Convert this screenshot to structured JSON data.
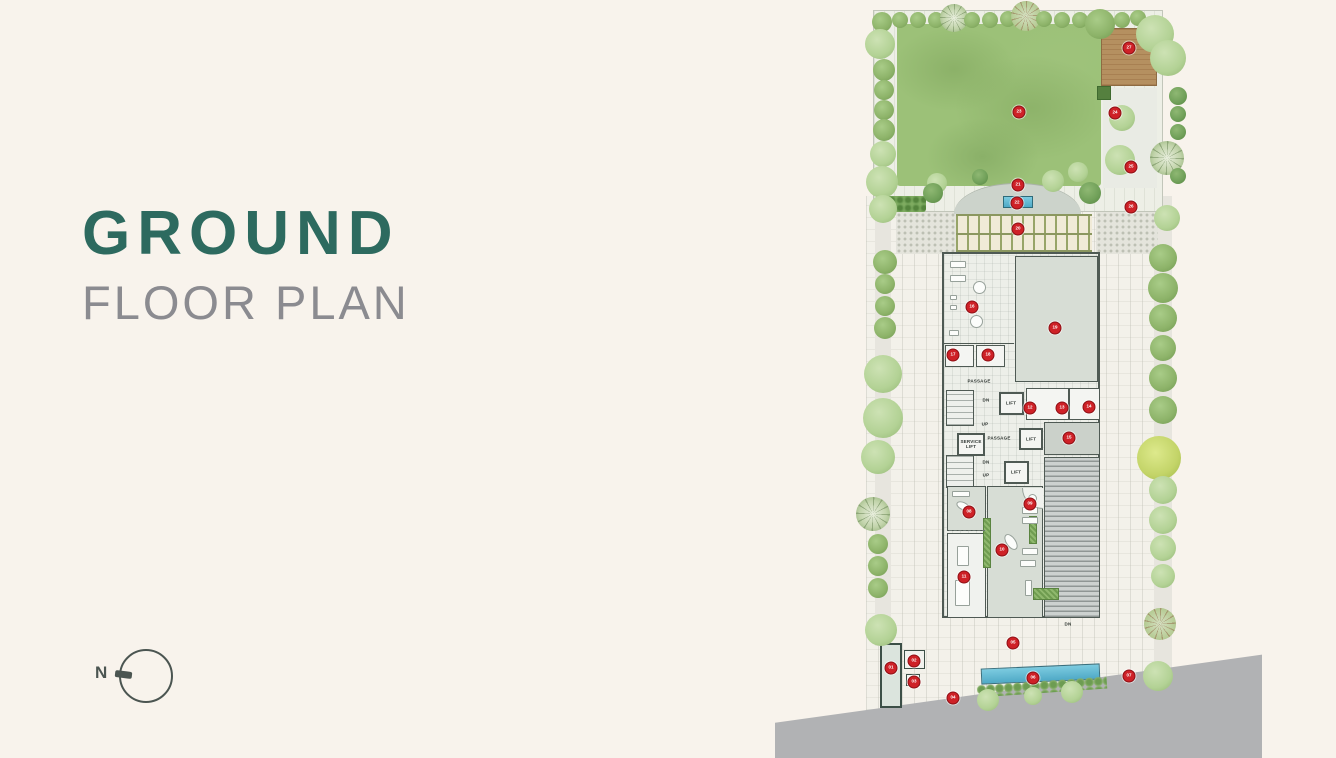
{
  "title": {
    "line1": "GROUND",
    "line2": "FLOOR PLAN"
  },
  "compass": {
    "label": "N"
  },
  "colors": {
    "background": "#f8f3ec",
    "title_accent": "#2d6a5f",
    "title_gray": "#8b8b90",
    "lawn": "#9cc178",
    "road": "#b1b2b4",
    "water": "#5cb8d3",
    "marker_red": "#ce2127",
    "deck_wood": "#b28a5b",
    "wall": "#4f5a54"
  },
  "plan": {
    "labels": [
      {
        "text": "PASSAGE",
        "x": 209,
        "y": 381
      },
      {
        "text": "DN",
        "x": 216,
        "y": 400
      },
      {
        "text": "UP",
        "x": 215,
        "y": 424
      },
      {
        "text": "LIFT",
        "x": 241,
        "y": 403
      },
      {
        "text": "SERVICE LIFT",
        "x": 201,
        "y": 444,
        "w": 24
      },
      {
        "text": "PASSAGE",
        "x": 229,
        "y": 438
      },
      {
        "text": "LIFT",
        "x": 261,
        "y": 439
      },
      {
        "text": "DN",
        "x": 216,
        "y": 462
      },
      {
        "text": "UP",
        "x": 216,
        "y": 475
      },
      {
        "text": "LIFT",
        "x": 246,
        "y": 472
      },
      {
        "text": "DN",
        "x": 298,
        "y": 624
      }
    ],
    "markers": [
      {
        "n": "01",
        "x": 121,
        "y": 668
      },
      {
        "n": "02",
        "x": 144,
        "y": 661
      },
      {
        "n": "03",
        "x": 144,
        "y": 682
      },
      {
        "n": "04",
        "x": 183,
        "y": 698
      },
      {
        "n": "05",
        "x": 243,
        "y": 643
      },
      {
        "n": "06",
        "x": 263,
        "y": 678
      },
      {
        "n": "07",
        "x": 359,
        "y": 676
      },
      {
        "n": "08",
        "x": 199,
        "y": 512
      },
      {
        "n": "09",
        "x": 260,
        "y": 504
      },
      {
        "n": "10",
        "x": 232,
        "y": 550
      },
      {
        "n": "11",
        "x": 194,
        "y": 577
      },
      {
        "n": "12",
        "x": 260,
        "y": 408
      },
      {
        "n": "13",
        "x": 292,
        "y": 408
      },
      {
        "n": "14",
        "x": 319,
        "y": 407
      },
      {
        "n": "15",
        "x": 299,
        "y": 438
      },
      {
        "n": "16",
        "x": 202,
        "y": 307
      },
      {
        "n": "17",
        "x": 183,
        "y": 355
      },
      {
        "n": "18",
        "x": 218,
        "y": 355
      },
      {
        "n": "19",
        "x": 285,
        "y": 328
      },
      {
        "n": "20",
        "x": 248,
        "y": 229
      },
      {
        "n": "21",
        "x": 248,
        "y": 185
      },
      {
        "n": "22",
        "x": 247,
        "y": 203
      },
      {
        "n": "23",
        "x": 249,
        "y": 112
      },
      {
        "n": "24",
        "x": 345,
        "y": 113
      },
      {
        "n": "25",
        "x": 361,
        "y": 167
      },
      {
        "n": "26",
        "x": 361,
        "y": 207
      },
      {
        "n": "27",
        "x": 359,
        "y": 48
      }
    ],
    "trees": [
      {
        "x": 112,
        "y": 22,
        "d": 20,
        "c": "d"
      },
      {
        "x": 130,
        "y": 20,
        "d": 16,
        "c": "d"
      },
      {
        "x": 148,
        "y": 20,
        "d": 16,
        "c": "d"
      },
      {
        "x": 166,
        "y": 20,
        "d": 16,
        "c": "d"
      },
      {
        "x": 184,
        "y": 18,
        "d": 28,
        "c": "b"
      },
      {
        "x": 202,
        "y": 20,
        "d": 16,
        "c": "d"
      },
      {
        "x": 220,
        "y": 20,
        "d": 16,
        "c": "d"
      },
      {
        "x": 238,
        "y": 19,
        "d": 16,
        "c": "d"
      },
      {
        "x": 256,
        "y": 16,
        "d": 30,
        "c": "w"
      },
      {
        "x": 274,
        "y": 19,
        "d": 16,
        "c": "d"
      },
      {
        "x": 292,
        "y": 20,
        "d": 16,
        "c": "d"
      },
      {
        "x": 310,
        "y": 20,
        "d": 16,
        "c": "d"
      },
      {
        "x": 330,
        "y": 24,
        "d": 30,
        "c": "d"
      },
      {
        "x": 352,
        "y": 20,
        "d": 16,
        "c": "d"
      },
      {
        "x": 368,
        "y": 18,
        "d": 16,
        "c": "d"
      },
      {
        "x": 385,
        "y": 34,
        "d": 38,
        "c": "p"
      },
      {
        "x": 110,
        "y": 44,
        "d": 30,
        "c": "p"
      },
      {
        "x": 114,
        "y": 70,
        "d": 22,
        "c": "d"
      },
      {
        "x": 114,
        "y": 90,
        "d": 20,
        "c": "d"
      },
      {
        "x": 114,
        "y": 110,
        "d": 20,
        "c": "d"
      },
      {
        "x": 114,
        "y": 130,
        "d": 22,
        "c": "d"
      },
      {
        "x": 113,
        "y": 154,
        "d": 26,
        "c": "p"
      },
      {
        "x": 112,
        "y": 182,
        "d": 32,
        "c": "p"
      },
      {
        "x": 113,
        "y": 209,
        "d": 28,
        "c": "p"
      },
      {
        "x": 167,
        "y": 183,
        "d": 20,
        "c": "p"
      },
      {
        "x": 163,
        "y": 193,
        "d": 20,
        "c": "t"
      },
      {
        "x": 210,
        "y": 177,
        "d": 16,
        "c": "t"
      },
      {
        "x": 283,
        "y": 181,
        "d": 22,
        "c": "p"
      },
      {
        "x": 308,
        "y": 172,
        "d": 20,
        "c": "p"
      },
      {
        "x": 320,
        "y": 193,
        "d": 22,
        "c": "t"
      },
      {
        "x": 352,
        "y": 118,
        "d": 26,
        "c": "p"
      },
      {
        "x": 350,
        "y": 160,
        "d": 30,
        "c": "p"
      },
      {
        "x": 398,
        "y": 58,
        "d": 36,
        "c": "p"
      },
      {
        "x": 408,
        "y": 96,
        "d": 18,
        "c": "t"
      },
      {
        "x": 408,
        "y": 114,
        "d": 16,
        "c": "t"
      },
      {
        "x": 408,
        "y": 132,
        "d": 16,
        "c": "t"
      },
      {
        "x": 397,
        "y": 158,
        "d": 34,
        "c": "b"
      },
      {
        "x": 408,
        "y": 176,
        "d": 16,
        "c": "t"
      },
      {
        "x": 397,
        "y": 218,
        "d": 26,
        "c": "p"
      },
      {
        "x": 393,
        "y": 258,
        "d": 28,
        "c": "d"
      },
      {
        "x": 393,
        "y": 288,
        "d": 30,
        "c": "d"
      },
      {
        "x": 393,
        "y": 318,
        "d": 28,
        "c": "d"
      },
      {
        "x": 393,
        "y": 348,
        "d": 26,
        "c": "d"
      },
      {
        "x": 393,
        "y": 378,
        "d": 28,
        "c": "d"
      },
      {
        "x": 393,
        "y": 410,
        "d": 28,
        "c": "d"
      },
      {
        "x": 389,
        "y": 458,
        "d": 44,
        "c": "y"
      },
      {
        "x": 393,
        "y": 490,
        "d": 28,
        "c": "p"
      },
      {
        "x": 393,
        "y": 520,
        "d": 28,
        "c": "p"
      },
      {
        "x": 393,
        "y": 548,
        "d": 26,
        "c": "p"
      },
      {
        "x": 393,
        "y": 576,
        "d": 24,
        "c": "p"
      },
      {
        "x": 390,
        "y": 624,
        "d": 32,
        "c": "w"
      },
      {
        "x": 388,
        "y": 676,
        "d": 30,
        "c": "p"
      },
      {
        "x": 115,
        "y": 262,
        "d": 24,
        "c": "d"
      },
      {
        "x": 115,
        "y": 284,
        "d": 20,
        "c": "d"
      },
      {
        "x": 115,
        "y": 306,
        "d": 20,
        "c": "d"
      },
      {
        "x": 115,
        "y": 328,
        "d": 22,
        "c": "d"
      },
      {
        "x": 113,
        "y": 374,
        "d": 38,
        "c": "p"
      },
      {
        "x": 113,
        "y": 418,
        "d": 40,
        "c": "p"
      },
      {
        "x": 108,
        "y": 457,
        "d": 34,
        "c": "p"
      },
      {
        "x": 103,
        "y": 514,
        "d": 34,
        "c": "b"
      },
      {
        "x": 108,
        "y": 544,
        "d": 20,
        "c": "d"
      },
      {
        "x": 108,
        "y": 566,
        "d": 20,
        "c": "d"
      },
      {
        "x": 108,
        "y": 588,
        "d": 20,
        "c": "d"
      },
      {
        "x": 111,
        "y": 630,
        "d": 32,
        "c": "p"
      },
      {
        "x": 218,
        "y": 700,
        "d": 22,
        "c": "p"
      },
      {
        "x": 263,
        "y": 696,
        "d": 18,
        "c": "p"
      },
      {
        "x": 302,
        "y": 692,
        "d": 22,
        "c": "p"
      }
    ]
  }
}
